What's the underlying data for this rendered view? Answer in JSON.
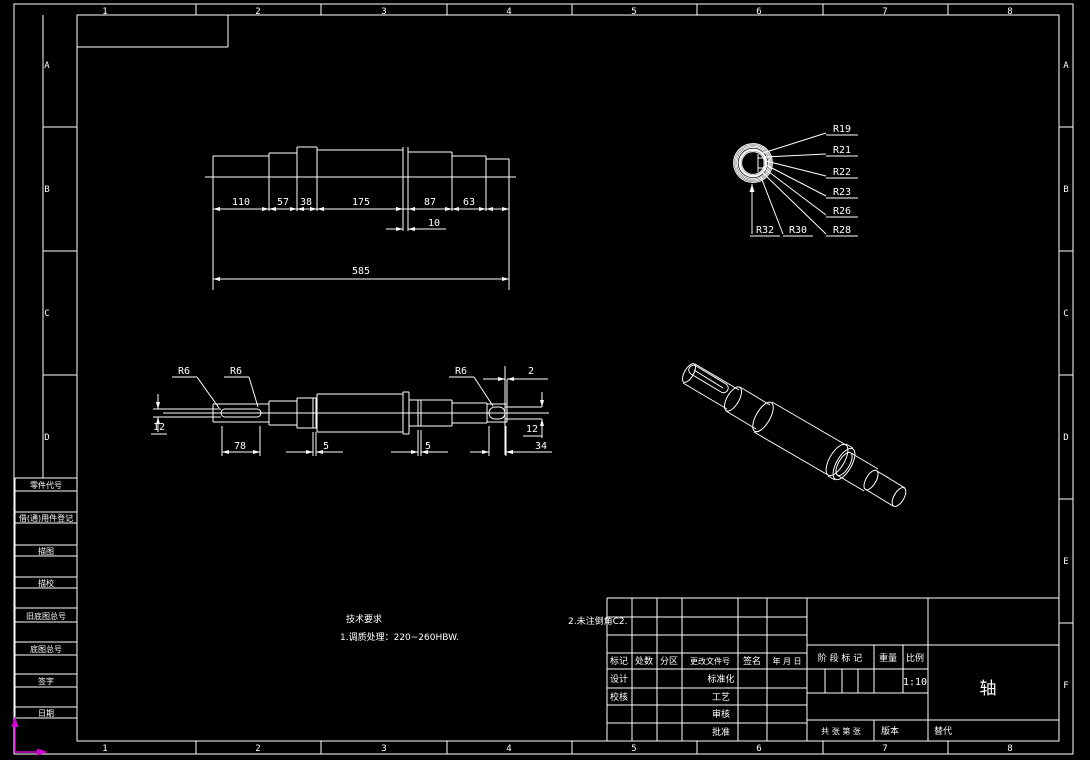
{
  "colors": {
    "bg": "#000000",
    "line": "#ffffff",
    "ucs_icon": "#d400d4"
  },
  "zones": {
    "top": [
      "1",
      "2",
      "3",
      "4",
      "5",
      "6",
      "7",
      "8"
    ],
    "bottom": [
      "1",
      "2",
      "3",
      "4",
      "5",
      "6",
      "7",
      "8"
    ],
    "left": [
      "A",
      "B",
      "C",
      "D"
    ],
    "right": [
      "A",
      "B",
      "C",
      "D",
      "E",
      "F"
    ]
  },
  "sidebar": {
    "rows": [
      "零件代号",
      "借(通)用件登记",
      "描图",
      "描校",
      "旧底图总号",
      "底图总号",
      "签字",
      "日期"
    ]
  },
  "tech_req": {
    "title": "技术要求",
    "item1": "1.调质处理：220~260HBW.",
    "item2": "2.未注倒角C2."
  },
  "front_view": {
    "d110": "110",
    "d57": "57",
    "d38": "38",
    "d175": "175",
    "d87": "87",
    "d63": "63",
    "d10": "10",
    "d585": "585"
  },
  "end_view": {
    "r19": "R19",
    "r21": "R21",
    "r22": "R22",
    "r23": "R23",
    "r26": "R26",
    "r28": "R28",
    "r30": "R30",
    "r32": "R32"
  },
  "side_view": {
    "r6a": "R6",
    "r6b": "R6",
    "r6c": "R6",
    "d2": "2",
    "d12l": "12",
    "d78": "78",
    "d5a": "5",
    "d5b": "5",
    "d12r": "12",
    "d34": "34"
  },
  "title_block": {
    "biaoji": "标记",
    "chushu": "处数",
    "fenqu": "分区",
    "genggai": "更改文件号",
    "qianming": "签名",
    "nianyueri": "年 月 日",
    "sheji": "设计",
    "jiaohe": "校核",
    "biaozhunhua": "标准化",
    "gongyi": "工艺",
    "shenhe": "审核",
    "pizhun": "批准",
    "jieduan": "阶 段 标 记",
    "zhongliang": "重量",
    "bili": "比例",
    "scale_value": "1:10",
    "part_name": "轴",
    "gongzhang": "共  张  第  张",
    "banben": "版本",
    "tidai": "替代"
  }
}
